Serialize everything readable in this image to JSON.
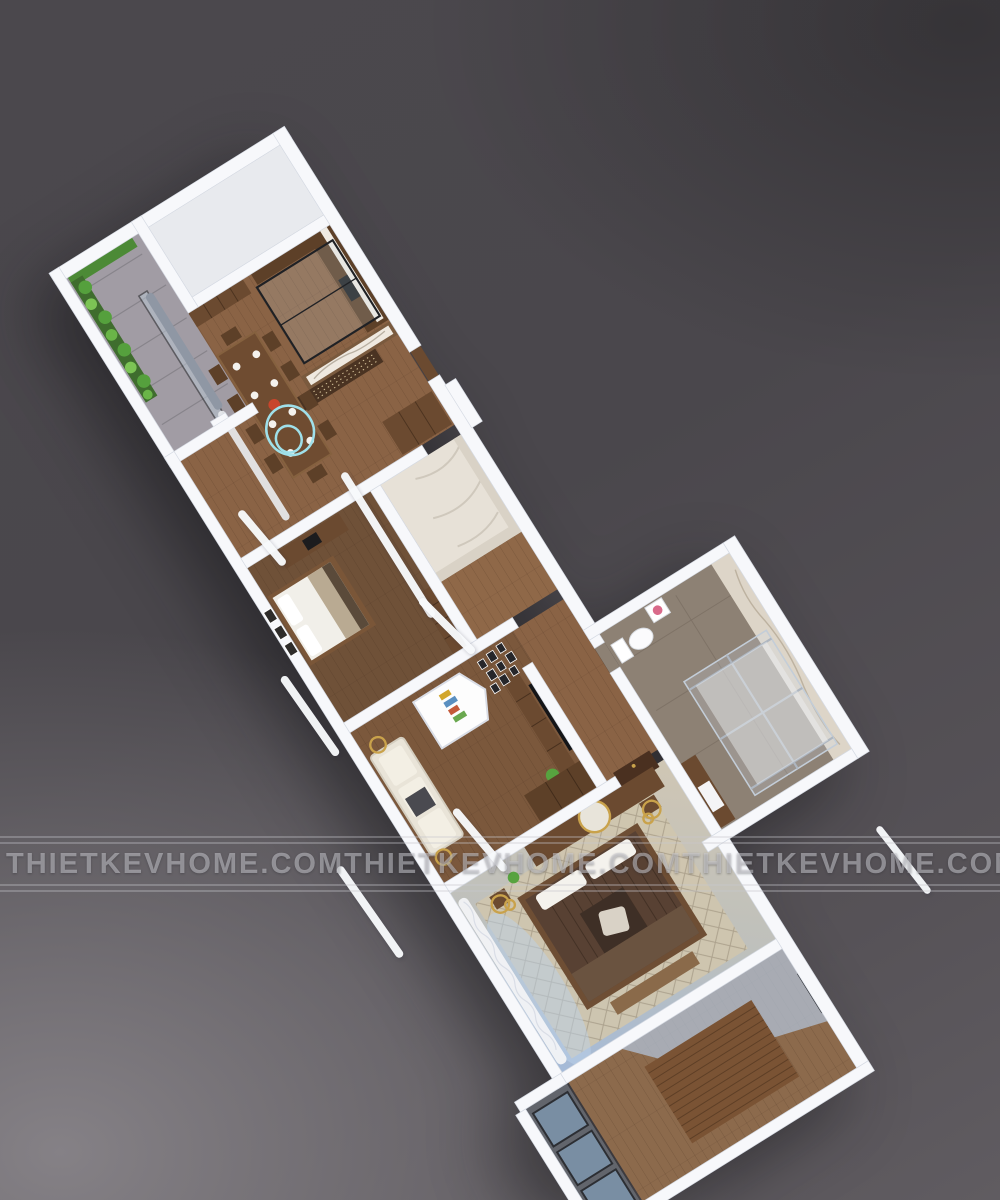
{
  "watermark": {
    "text": "THIETKEVHOME.COM",
    "repeat_count": 5
  },
  "scene": {
    "description": "3D cutaway floor-plan render of an apartment viewed from above on a dark studio background",
    "rooms": [
      {
        "name": "balcony-garden",
        "items": [
          "vertical-plant-wall",
          "planter-boxes",
          "sliding-glass-door"
        ]
      },
      {
        "name": "dining-room",
        "items": [
          "wooden-dining-table-8-seats",
          "display-shelf",
          "double-ring-pendant-light",
          "gray-curtains"
        ]
      },
      {
        "name": "kitchen",
        "items": [
          "dark-wood-l-cabinets",
          "black-framed-glass-partition",
          "marble-backsplash"
        ]
      },
      {
        "name": "entry-hall",
        "items": [
          "marble-feature-wall",
          "carved-wood-screen",
          "shoe-cabinet",
          "entry-door"
        ]
      },
      {
        "name": "wc",
        "items": [
          "marble-tiling"
        ]
      },
      {
        "name": "bedroom-2",
        "items": [
          "double-bed",
          "three-wall-pictures",
          "study-desk-with-monitor",
          "long-wardrobe"
        ]
      },
      {
        "name": "living-room",
        "items": [
          "wall-tv",
          "wood-tv-console",
          "house-shaped-shelf",
          "photo-gallery-wall",
          "fabric-sofa",
          "corner-wardrobe",
          "plant"
        ]
      },
      {
        "name": "hallway",
        "items": [
          "gold-framed-artwork",
          "dark-wood-door"
        ]
      },
      {
        "name": "master-bedroom",
        "items": [
          "king-bed-brown-duvet",
          "diamond-pattern-rug",
          "wardrobe-with-round-mirror",
          "gold-ring-pendant-lamps",
          "white-curtains",
          "foot-bench"
        ]
      },
      {
        "name": "master-bathroom",
        "items": [
          "glass-shower-chrome-frame",
          "toilet",
          "wood-vanity",
          "marble-wall",
          "flower-table"
        ]
      },
      {
        "name": "bedroom-3",
        "items": [
          "wood-platform",
          "window-black-frame"
        ]
      },
      {
        "name": "loggia",
        "items": [
          "dark-framed-glazing"
        ]
      }
    ]
  },
  "colors": {
    "background_dark": "#4a474c",
    "background_light": "#858186",
    "wall_white": "#f7f8fb",
    "wood_dark": "#5d4028",
    "wood_mid": "#6b4a30",
    "floor_wood": "#8a6345",
    "floor_blue_glow": "#b3c5db",
    "marble": "#e7e1d7",
    "plant_green": "#55a03d",
    "accent_cyan": "#9fe0ea",
    "accent_gold": "#c9a24b",
    "watermark_gray": "#cfcfd5"
  }
}
